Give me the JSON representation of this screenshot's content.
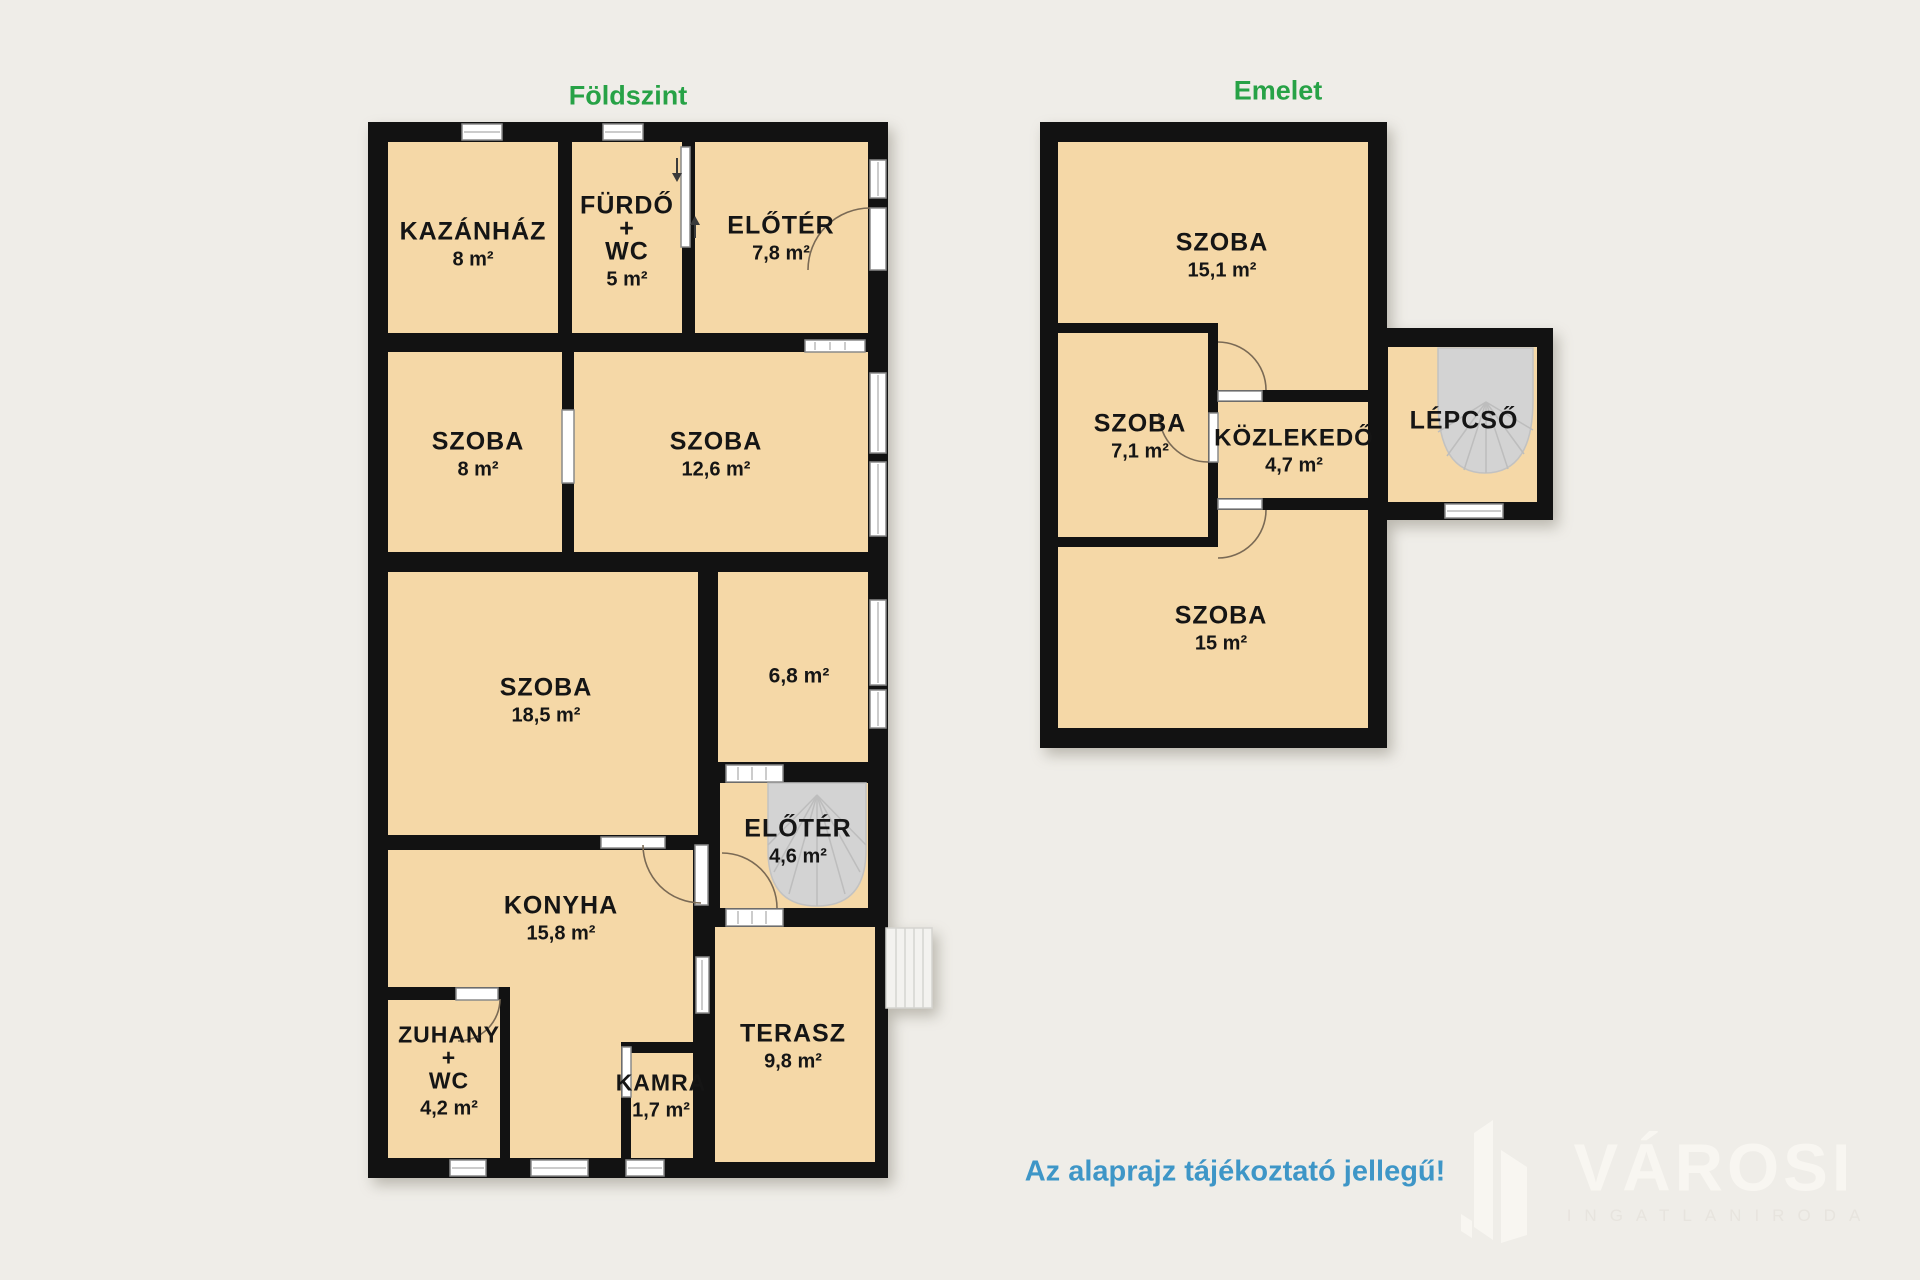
{
  "titles": {
    "ground": "Földszint",
    "upper": "Emelet"
  },
  "disclaimer": "Az alaprajz tájékoztató jellegű!",
  "logo": {
    "name": "VÁROSI",
    "subtitle": "INGATLANIRODA"
  },
  "colors": {
    "background": "#efede8",
    "wall": "#121212",
    "room_fill": "#f5d8a7",
    "stair_gray": "#d3d3d3",
    "title_green": "#27a246",
    "disclaimer_blue": "#3e96c7"
  },
  "ground_floor": {
    "rooms": [
      {
        "name": "KAZÁNHÁZ",
        "area": "8 m²"
      },
      {
        "lines": [
          "FÜRDŐ",
          "+",
          "WC"
        ],
        "area": "5 m²"
      },
      {
        "name": "ELŐTÉR",
        "area": "7,8 m²"
      },
      {
        "name": "SZOBA",
        "area": "8 m²"
      },
      {
        "name": "SZOBA",
        "area": "12,6 m²"
      },
      {
        "name": "SZOBA",
        "area": "18,5 m²"
      },
      {
        "name": "",
        "area": "6,8 m²"
      },
      {
        "name": "ELŐTÉR",
        "area": "4,6 m²"
      },
      {
        "name": "KONYHA",
        "area": "15,8 m²"
      },
      {
        "lines": [
          "ZUHANY",
          "+",
          "WC"
        ],
        "area": "4,2 m²"
      },
      {
        "name": "KAMRA",
        "area": "1,7 m²"
      },
      {
        "name": "TERASZ",
        "area": "9,8 m²"
      }
    ]
  },
  "upper_floor": {
    "rooms": [
      {
        "name": "SZOBA",
        "area": "15,1 m²"
      },
      {
        "name": "SZOBA",
        "area": "7,1 m²"
      },
      {
        "name": "KÖZLEKEDŐ",
        "area": "4,7 m²"
      },
      {
        "name": "LÉPCSŐ",
        "area": ""
      },
      {
        "name": "SZOBA",
        "area": "15 m²"
      }
    ]
  }
}
